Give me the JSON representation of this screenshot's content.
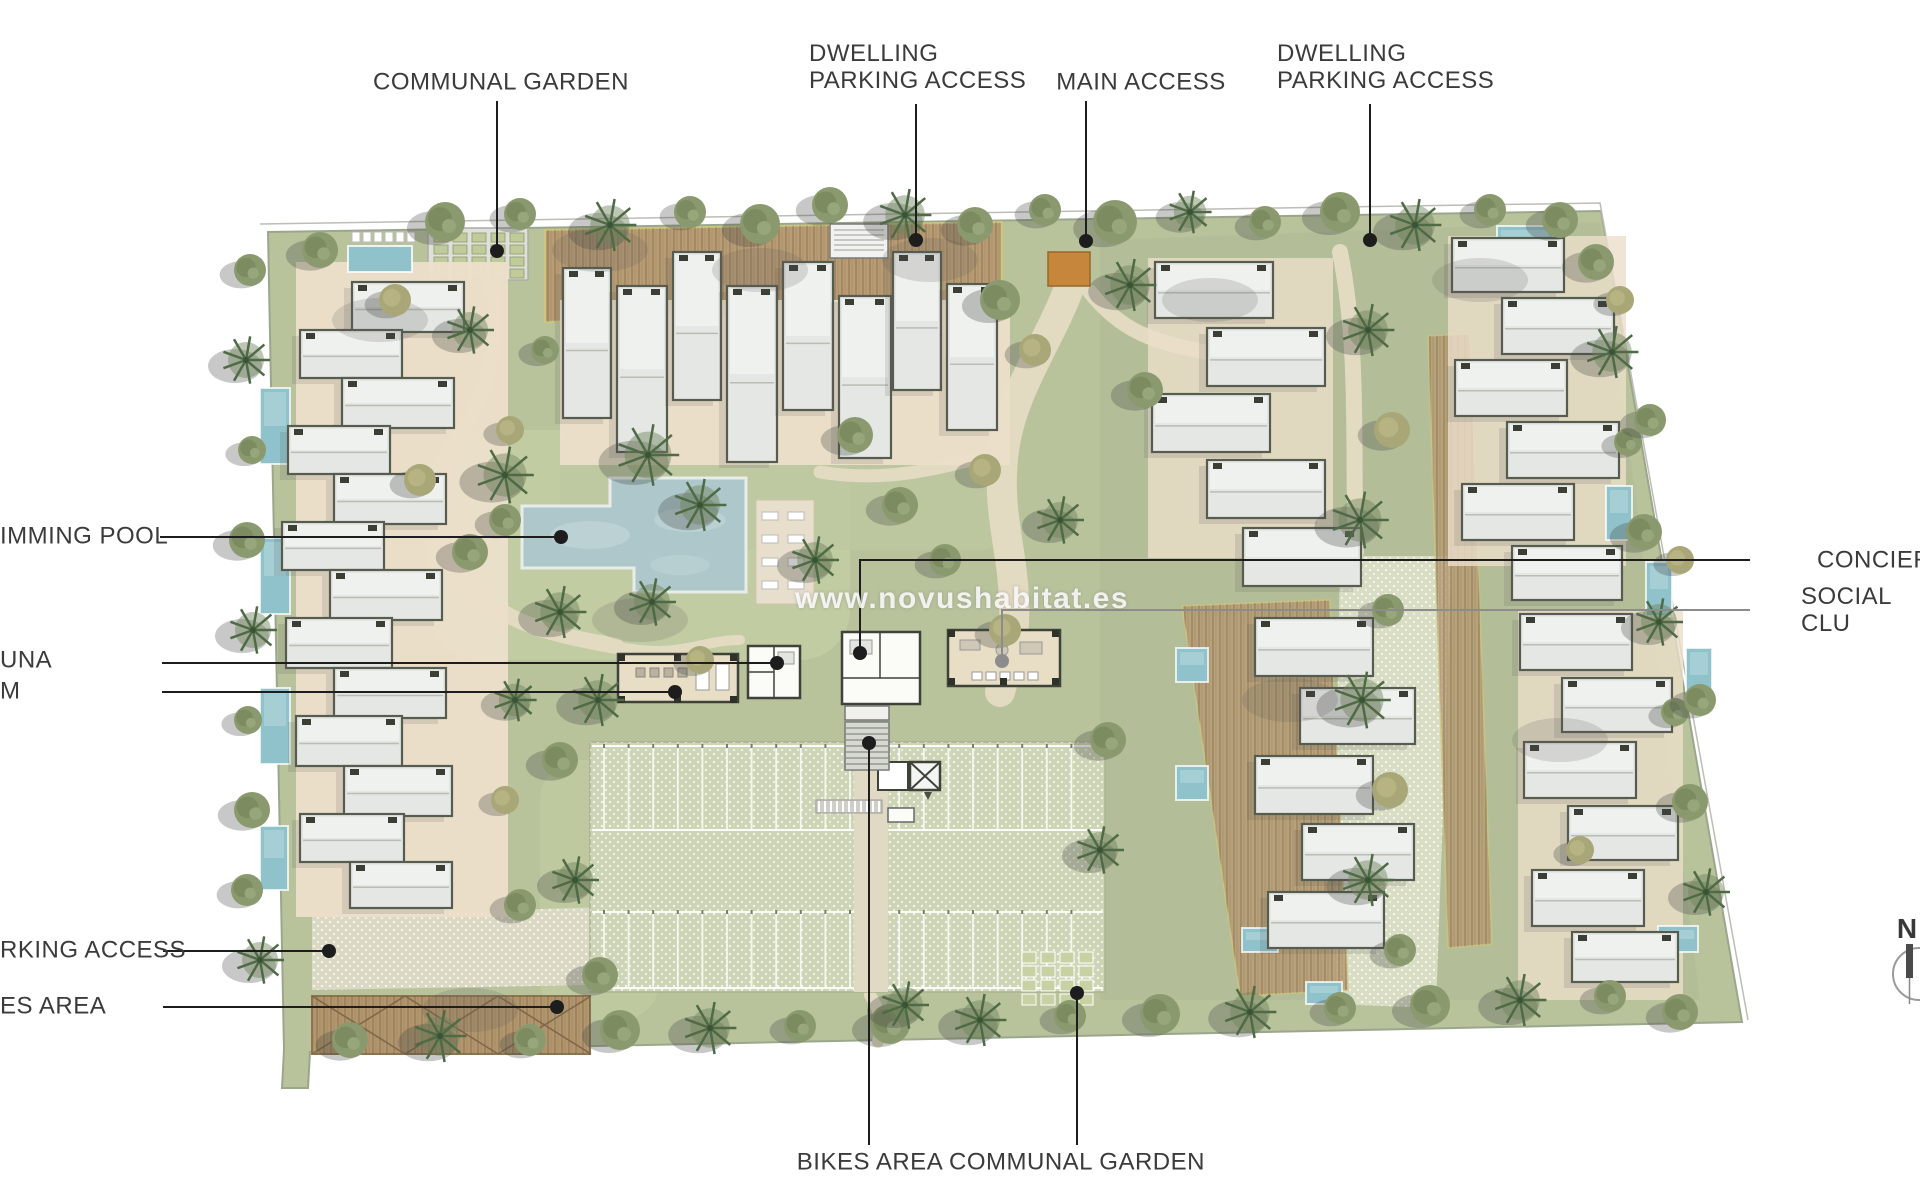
{
  "title": "Residential development site plan",
  "watermark": {
    "text": "www.novushabitat.es"
  },
  "compass": {
    "label": "N"
  },
  "colors": {
    "site_green": "#b8c39c",
    "lawn_light": "#c3cda4",
    "zone_dull": "#afba95",
    "path_beige": "#e3dac2",
    "dotted_pave": "#d8ddc3",
    "parking_surface": "#ced5b6",
    "pool_blue": "#adc7cb",
    "small_pool_blue": "#8fc2cb",
    "roof_gray": "#e4e7e3",
    "roof_stroke": "#575c50",
    "terrace_beige": "#ecdfca",
    "deck_brown": "#b79d76",
    "deck_edge": "#cdc67f",
    "club_beige": "#e8ddc5",
    "wall_dark": "#3e4339",
    "gate_orange": "#c6873d",
    "label_color": "#3b3b3b",
    "leader": "#1d1d1d"
  },
  "annotations": [
    {
      "id": "communal-garden-top",
      "text": "COMMUNAL GARDEN",
      "label": {
        "x": 501,
        "y": 82,
        "anchor": "center"
      },
      "line": [
        [
          497,
          101
        ],
        [
          497,
          246
        ]
      ],
      "dot": [
        497,
        251
      ]
    },
    {
      "id": "dwelling-parking-access-left",
      "text": "DWELLING\nPARKING ACCESS",
      "label": {
        "x": 809,
        "y": 67,
        "anchor": "left"
      },
      "line": [
        [
          916,
          104
        ],
        [
          916,
          235
        ]
      ],
      "dot": [
        916,
        240
      ]
    },
    {
      "id": "main-access",
      "text": "MAIN ACCESS",
      "label": {
        "x": 1141,
        "y": 82,
        "anchor": "center"
      },
      "line": [
        [
          1086,
          101
        ],
        [
          1086,
          236
        ]
      ],
      "dot": [
        1086,
        241
      ]
    },
    {
      "id": "dwelling-parking-access-right",
      "text": "DWELLING\nPARKING ACCESS",
      "label": {
        "x": 1277,
        "y": 67,
        "anchor": "left"
      },
      "line": [
        [
          1370,
          104
        ],
        [
          1370,
          235
        ]
      ],
      "dot": [
        1370,
        240
      ]
    },
    {
      "id": "swimming-pool",
      "text": "IMMING POOL",
      "label": {
        "x": 0,
        "y": 536,
        "anchor": "left"
      },
      "line": [
        [
          160,
          537
        ],
        [
          555,
          537
        ]
      ],
      "dot": [
        561,
        537
      ]
    },
    {
      "id": "sauna",
      "text": "UNA",
      "label": {
        "x": 0,
        "y": 660,
        "anchor": "left"
      },
      "line": [
        [
          162,
          663
        ],
        [
          771,
          663
        ]
      ],
      "dot": [
        777,
        663
      ]
    },
    {
      "id": "gym",
      "text": "M",
      "label": {
        "x": 0,
        "y": 691,
        "anchor": "left"
      },
      "line": [
        [
          162,
          692
        ],
        [
          669,
          692
        ]
      ],
      "dot": [
        675,
        692
      ]
    },
    {
      "id": "parking-access",
      "text": "RKING ACCESS",
      "label": {
        "x": 0,
        "y": 950,
        "anchor": "left"
      },
      "line": [
        [
          163,
          951
        ],
        [
          323,
          951
        ]
      ],
      "dot": [
        329,
        951
      ]
    },
    {
      "id": "bikes-area-left",
      "text": "ES AREA",
      "label": {
        "x": 0,
        "y": 1006,
        "anchor": "left"
      },
      "line": [
        [
          163,
          1007
        ],
        [
          551,
          1007
        ]
      ],
      "dot": [
        557,
        1007
      ]
    },
    {
      "id": "concierge",
      "text": "CONCIERG",
      "label": {
        "x": 1817,
        "y": 560,
        "anchor": "left"
      },
      "line": [
        [
          1750,
          560
        ],
        [
          860,
          560
        ],
        [
          860,
          648
        ]
      ],
      "dot": [
        860,
        653
      ]
    },
    {
      "id": "social-club",
      "text": "SOCIAL CLU",
      "label": {
        "x": 1801,
        "y": 610,
        "anchor": "left"
      },
      "line": [
        [
          1750,
          610
        ],
        [
          1002,
          610
        ],
        [
          1002,
          656
        ]
      ],
      "dot": [
        1002,
        661
      ],
      "line_color": "#8c8c8c"
    },
    {
      "id": "bikes-area-bottom",
      "text": "BIKES AREA",
      "label": {
        "x": 870,
        "y": 1162,
        "anchor": "center"
      },
      "line": [
        [
          869,
          1145
        ],
        [
          869,
          748
        ]
      ],
      "dot": [
        869,
        743
      ]
    },
    {
      "id": "communal-garden-bottom",
      "text": "COMMUNAL GARDEN",
      "label": {
        "x": 1077,
        "y": 1162,
        "anchor": "center"
      },
      "line": [
        [
          1077,
          1145
        ],
        [
          1077,
          998
        ]
      ],
      "dot": [
        1077,
        993
      ]
    }
  ]
}
